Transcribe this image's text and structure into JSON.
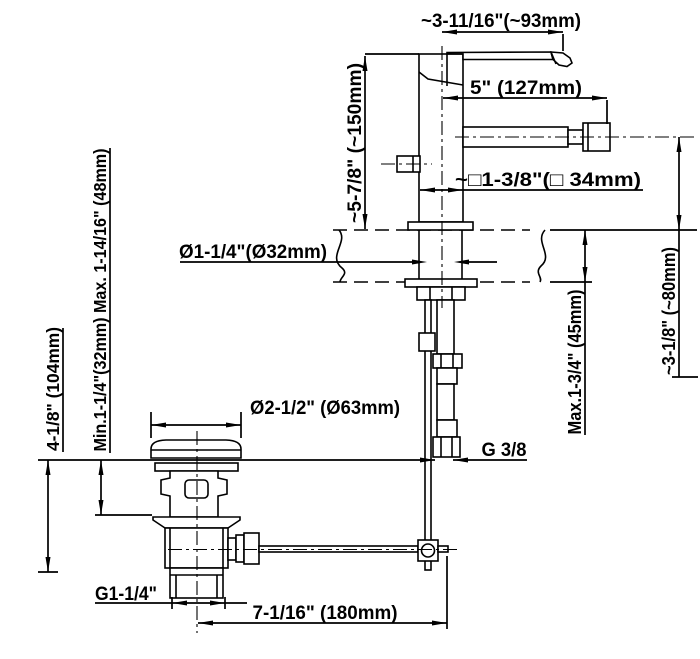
{
  "drawing": {
    "title": "bidet-mixer-with-pop-up-drain-dimension-drawing",
    "accent_color": "#000000",
    "background_color": "#ffffff",
    "labels": {
      "handle_reach": "~3-11/16\"(~93mm)",
      "spray_length": "5\" (127mm)",
      "body_height": "~5-7/8\" (~150mm)",
      "body_square": "~□1-3/8\"(□ 34mm)",
      "deck_hole": "Ø1-1/4\"(Ø32mm)",
      "counter_thickness": "Max.1-3/4\" (45mm)",
      "spray_height": "~3-1/8\" (~80mm)",
      "clamp_range": "Min.1-1/4\"(32mm) Max. 1-14/16\" (48mm)",
      "drain_depth": "4-1/8\" (104mm)",
      "cap_diameter": "Ø2-1/2\" (Ø63mm)",
      "supply_thread": "G 3/8",
      "drain_thread": "G1-1/4\"",
      "rod_offset": "7-1/16\" (180mm)"
    }
  }
}
